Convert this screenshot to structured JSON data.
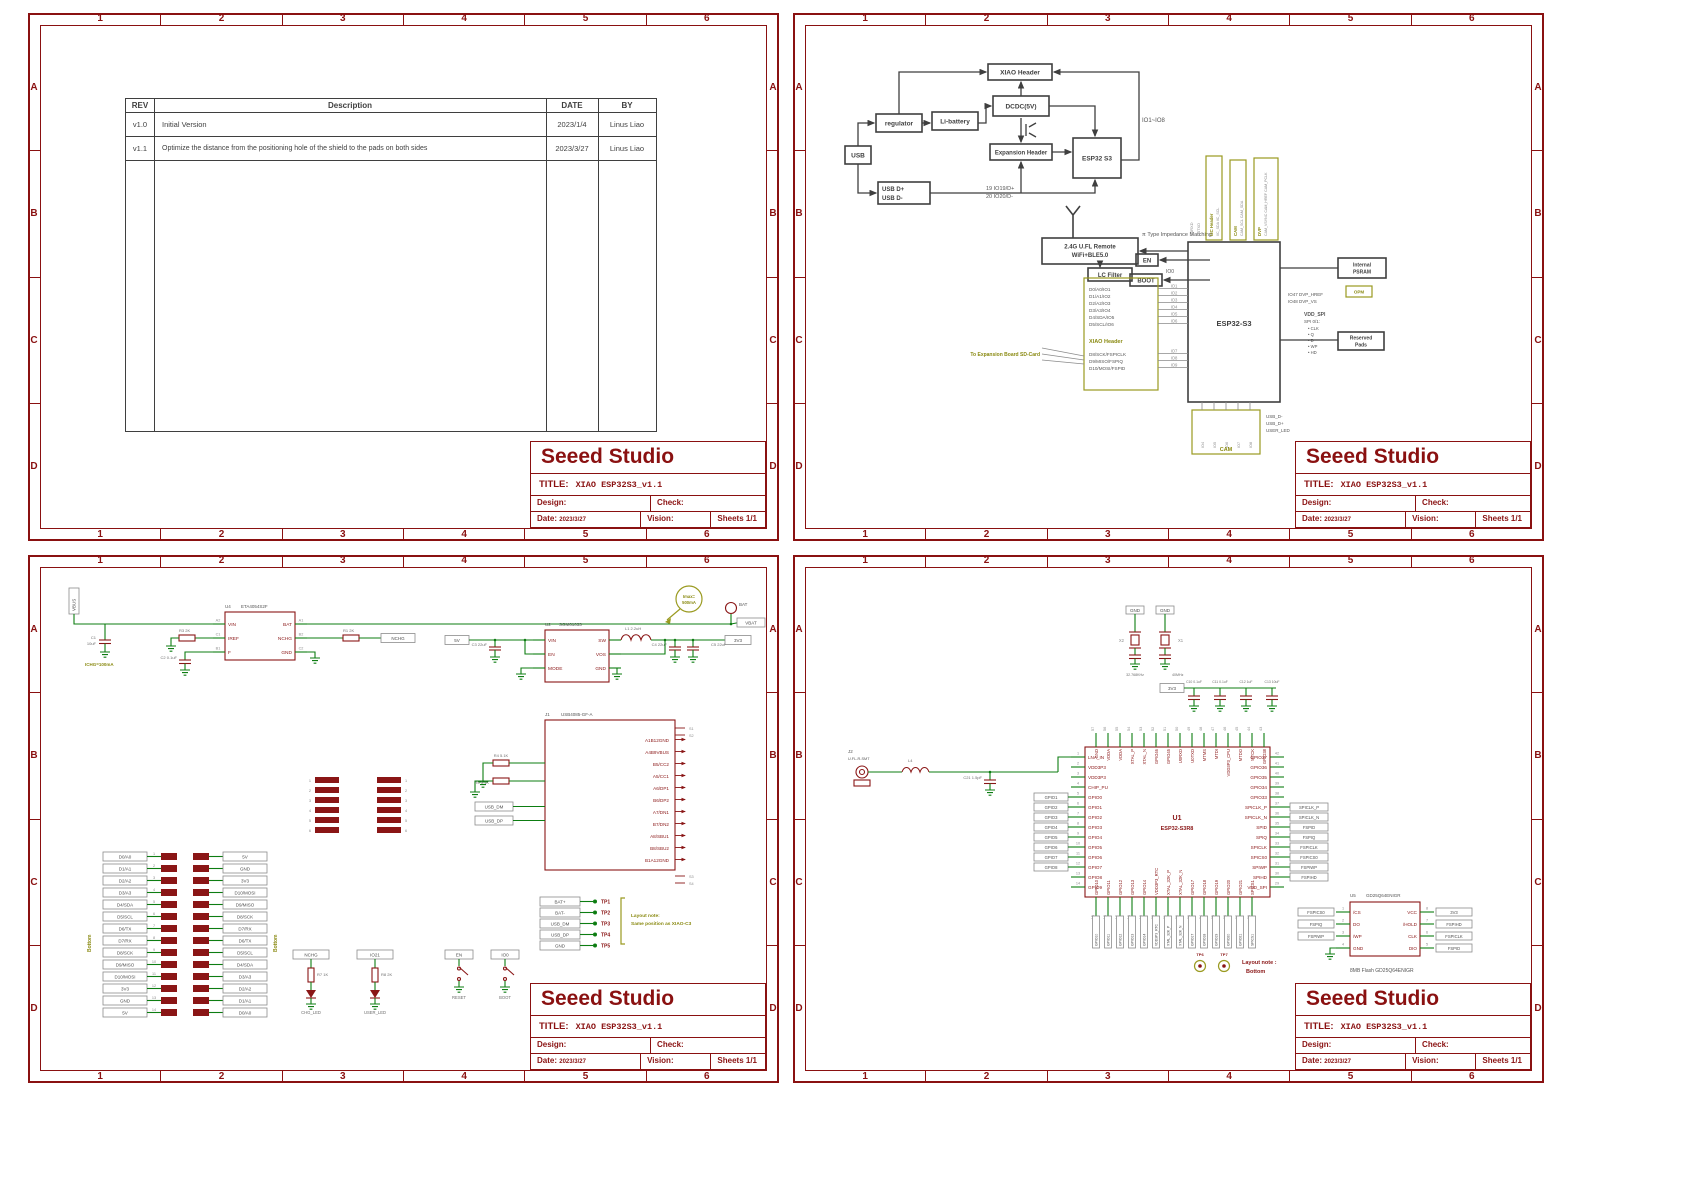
{
  "frame": {
    "cols": [
      "1",
      "2",
      "3",
      "4",
      "5",
      "6"
    ],
    "rows": [
      "A",
      "B",
      "C",
      "D"
    ]
  },
  "title_block": {
    "company": "Seeed Studio",
    "title_label": "TITLE:",
    "title": "XIAO ESP32S3_v1.1",
    "design_label": "Design:",
    "check_label": "Check:",
    "date_label": "Date:",
    "date_value": "2023/3/27",
    "vision_label": "Vision:",
    "sheets_value": "Sheets 1/1"
  },
  "rev_table": {
    "headers": [
      "REV",
      "Description",
      "DATE",
      "BY"
    ],
    "rows": [
      {
        "rev": "v1.0",
        "desc": "Initial Version",
        "date": "2023/1/4",
        "by": "Linus Liao"
      },
      {
        "rev": "v1.1",
        "desc": "Optimize the distance from the positioning hole of the shield to the pads on both sides",
        "date": "2023/3/27",
        "by": "Linus Liao"
      }
    ]
  },
  "p2": {
    "bd": {
      "usb": "USB",
      "regulator": "regulator",
      "li_battery": "Li-battery",
      "xiao_header": "XIAO Header",
      "dcdc": "DCDC(5V)",
      "expansion": "Expansion Header",
      "esp32": "ESP32 S3",
      "usb_dp": "USB D+",
      "usb_dn": "USB D-",
      "net_dp": "19 IO19/D+",
      "net_dn": "20 IO20/D-",
      "io_range": "IO1~IO8"
    },
    "rf": {
      "remote1": "2.4G U.FL Remote",
      "remote2": "WiFi+BLE5.0",
      "matching": "π Type Impedance Matching",
      "lc": "LC Filter",
      "en": "EN",
      "boot": "BOOT",
      "io0": "IO0",
      "chip": "ESP32-S3",
      "xiao_label": "XIAO Header",
      "list_a": [
        "D0/A0/IO1",
        "D1/A1/IO2",
        "D2/A2/IO3",
        "D3/A3/IO4",
        "D4/SDA/IO5",
        "D5/SCL/IO6"
      ],
      "nums_a": [
        "IO1",
        "IO2",
        "IO3",
        "IO4",
        "IO5",
        "IO6"
      ],
      "list_b": [
        "D8/SCK/FSPICLK",
        "D9/MISO/FSPIQ",
        "D10/MOSI/FSPID"
      ],
      "nums_b": [
        "IO7",
        "IO8",
        "IO9"
      ],
      "sd_note": "To Expansion Board SD-Card",
      "vboxes": [
        {
          "cap": "I2C Header",
          "nets": "IIC_SDA IIC_SCL"
        },
        {
          "cap": "CAM",
          "nets": "CAM_SCL CAM_SDA"
        },
        {
          "cap": "DVP",
          "nets": "CAM_VSYNC CAM_HREF CAM_PCLK"
        }
      ],
      "u0": [
        "U0RXD",
        "U0TXD"
      ],
      "psram1": "Internal",
      "psram2": "PSRAM",
      "opm": "OPM",
      "dvp1": "IO47  DVP_HREF",
      "dvp2": "IO48  DVP_VS",
      "vdd_spi": "VDD_SPI",
      "spi01": "SPI 0/1:",
      "spi_list": [
        "• CLK",
        "• Q",
        "• D",
        "• WP",
        "• HD"
      ],
      "reserved1": "Reserved",
      "reserved2": "Pads",
      "cam": "CAM",
      "cam_nets": [
        "IO4",
        "IO5",
        "IO6",
        "IO7",
        "IO8"
      ],
      "below": [
        "USB_D-",
        "USB_D+",
        "USER_LED"
      ]
    }
  },
  "p3": {
    "vbus": "VBUS",
    "u4": "U4",
    "u4_part": "ETA4054S2F",
    "u4_lpins": [
      {
        "n": "A2",
        "p": "VIN"
      },
      {
        "n": "C1",
        "p": "IREF"
      },
      {
        "n": "B1",
        "p": "F"
      }
    ],
    "u4_rpins": [
      {
        "n": "A1",
        "p": "BAT"
      },
      {
        "n": "B2",
        "p": "NCHG"
      },
      {
        "n": "C2",
        "p": "GND"
      }
    ],
    "c1": "C1",
    "c1v": "10uF",
    "r3": "R3 2K",
    "c2": "C2 0.1uF",
    "chg_note": "ICHG=100mA",
    "bat": "BAT",
    "vbat": "VBAT",
    "nchg": "NCHG",
    "r1": "R1 2K",
    "imax1": "Imax=",
    "imax2": "500mA",
    "v5": "5V",
    "u2": "U2",
    "u2_part": "SGM61033",
    "u2_l": [
      "VIN",
      "EN",
      "MODE"
    ],
    "u2_r": [
      "SW",
      "VOS",
      "GND"
    ],
    "l1": "L1 2.2uH",
    "c3": "C3 22uF",
    "c4": "C4 22uF",
    "c5": "C5 22uF",
    "v33": "3V3",
    "j1": "J1",
    "j1_part": "USB4085-GF-A",
    "usbc_pins": [
      "A1B12GND",
      "A4B9VBUS",
      "B5/CC2",
      "A5/CC1",
      "A6/DP1",
      "B6/DP2",
      "A7/DN1",
      "B7/DN2",
      "A8/SBU1",
      "B8/SBU2",
      "B1A12GND"
    ],
    "s_top": [
      "S1",
      "S2"
    ],
    "s_bot": [
      "S3",
      "S4"
    ],
    "r4": "R4 5.1K",
    "r5": "R5 5.1K",
    "dm": "USB_DM",
    "dp": "USB_DP",
    "tp": [
      {
        "net": "BAT+",
        "tp": "TP1"
      },
      {
        "net": "BAT-",
        "tp": "TP2"
      },
      {
        "net": "USB_DM",
        "tp": "TP3"
      },
      {
        "net": "USB_DP",
        "tp": "TP4"
      },
      {
        "net": "GND",
        "tp": "TP5"
      }
    ],
    "tp_note1": "Layout note:",
    "tp_note2": "Same position as XIAO-C3",
    "hdr_left": [
      "D0/A0",
      "D1/A1",
      "D2/A2",
      "D3/A3",
      "D4/SDA",
      "D5/SCL",
      "D6/TX",
      "D7/RX",
      "D8/SCK",
      "D9/MISO",
      "D10/MOSI",
      "3V3",
      "GND",
      "5V"
    ],
    "hdr_right": [
      "5V",
      "GND",
      "3V3",
      "D10/MOSI",
      "D9/MISO",
      "D8/SCK",
      "D7/RX",
      "D6/TX",
      "D5/SCL",
      "D4/SDA",
      "D3/A3",
      "D2/A2",
      "D1/A1",
      "D0/A0"
    ],
    "hdr_nums": [
      "1",
      "2",
      "3",
      "4",
      "5",
      "6",
      "7",
      "8",
      "9",
      "10",
      "11",
      "12",
      "13",
      "14"
    ],
    "bottom_note": "Bottom",
    "padsA": [
      "1",
      "2",
      "3",
      "4",
      "5",
      "6"
    ],
    "padsB": [
      "1",
      "2",
      "3",
      "4",
      "5",
      "6"
    ],
    "leds": [
      {
        "net": "NCHG",
        "r": "R7 1K",
        "name": "CHG_LED"
      },
      {
        "net": "IO21",
        "r": "R8 2K",
        "name": "USER_LED"
      }
    ],
    "btns": [
      {
        "net": "EN",
        "name": "RESET"
      },
      {
        "net": "IO0",
        "name": "BOOT"
      }
    ]
  },
  "p4": {
    "gnd2": [
      "GND",
      "GND"
    ],
    "x2": "X2",
    "x1": "X1",
    "x2v": "32.768KHz",
    "x1v": "40MHz",
    "rail": "3V3",
    "caps": [
      "C10 0.1uF",
      "C11 0.1uF",
      "C12 1uF",
      "C13 10uF"
    ],
    "j2": "J2",
    "j2_part": "U.FL-R-SMT",
    "l4": "L4",
    "c21": "C21 1.5pF",
    "mcu_ref": "U1",
    "mcu_part": "ESP32-S3R8",
    "left": [
      {
        "n": "1",
        "p": "LNA_IN"
      },
      {
        "n": "2",
        "p": "VDD3P3"
      },
      {
        "n": "3",
        "p": "VDD3P3"
      },
      {
        "n": "4",
        "p": "CHIP_PU"
      },
      {
        "n": "5",
        "p": "GPIO0"
      },
      {
        "n": "6",
        "p": "GPIO1"
      },
      {
        "n": "7",
        "p": "GPIO2"
      },
      {
        "n": "8",
        "p": "GPIO3"
      },
      {
        "n": "9",
        "p": "GPIO4"
      },
      {
        "n": "10",
        "p": "GPIO5"
      },
      {
        "n": "11",
        "p": "GPIO6"
      },
      {
        "n": "12",
        "p": "GPIO7"
      },
      {
        "n": "13",
        "p": "GPIO8"
      },
      {
        "n": "14",
        "p": "GPIO9"
      }
    ],
    "bottom": [
      {
        "n": "15",
        "p": "GPIO10"
      },
      {
        "n": "16",
        "p": "GPIO11"
      },
      {
        "n": "17",
        "p": "GPIO12"
      },
      {
        "n": "18",
        "p": "GPIO13"
      },
      {
        "n": "19",
        "p": "GPIO14"
      },
      {
        "n": "20",
        "p": "VDD3P3_RTC"
      },
      {
        "n": "21",
        "p": "XTAL_32K_P"
      },
      {
        "n": "22",
        "p": "XTAL_32K_N"
      },
      {
        "n": "23",
        "p": "GPIO17"
      },
      {
        "n": "24",
        "p": "GPIO18"
      },
      {
        "n": "25",
        "p": "GPIO19"
      },
      {
        "n": "26",
        "p": "GPIO20"
      },
      {
        "n": "27",
        "p": "GPIO21"
      },
      {
        "n": "28",
        "p": "SPICS1"
      }
    ],
    "right": [
      {
        "n": "42",
        "p": "GPIO37"
      },
      {
        "n": "41",
        "p": "GPIO36"
      },
      {
        "n": "40",
        "p": "GPIO35"
      },
      {
        "n": "39",
        "p": "GPIO34"
      },
      {
        "n": "38",
        "p": "GPIO33"
      },
      {
        "n": "37",
        "p": "SPICLK_P"
      },
      {
        "n": "36",
        "p": "SPICLK_N"
      },
      {
        "n": "35",
        "p": "SPID"
      },
      {
        "n": "34",
        "p": "SPIQ"
      },
      {
        "n": "33",
        "p": "SPICLK"
      },
      {
        "n": "32",
        "p": "SPICS0"
      },
      {
        "n": "31",
        "p": "SPIWP"
      },
      {
        "n": "30",
        "p": "SPIHD"
      },
      {
        "n": "29",
        "p": "VDD_SPI"
      }
    ],
    "top": [
      {
        "n": "57",
        "p": "GND"
      },
      {
        "n": "56",
        "p": "VDDA"
      },
      {
        "n": "55",
        "p": "VDDA"
      },
      {
        "n": "54",
        "p": "XTAL_P"
      },
      {
        "n": "53",
        "p": "XTAL_N"
      },
      {
        "n": "52",
        "p": "GPIO46"
      },
      {
        "n": "51",
        "p": "GPIO45"
      },
      {
        "n": "50",
        "p": "U0RXD"
      },
      {
        "n": "49",
        "p": "U0TXD"
      },
      {
        "n": "48",
        "p": "MTMS"
      },
      {
        "n": "47",
        "p": "MTDI"
      },
      {
        "n": "46",
        "p": "VDD3P3_CPU"
      },
      {
        "n": "45",
        "p": "MTDO"
      },
      {
        "n": "44",
        "p": "MTCK"
      },
      {
        "n": "43",
        "p": "GPIO38"
      }
    ],
    "left_nets": [
      "GPIO1",
      "GPIO2",
      "GPIO3",
      "GPIO4",
      "GPIO5",
      "GPIO6",
      "GPIO7",
      "GPIO8"
    ],
    "right_nets": [
      "SPICLK_P",
      "SPICLK_N",
      "FSPID",
      "FSPIQ",
      "FSPICLK",
      "FSPICS0",
      "FSPIWP",
      "FSPIHD"
    ],
    "tps": [
      "TP6",
      "TP7"
    ],
    "note1": "Layout note :",
    "note2": "Bottom",
    "flash_ref": "U5",
    "flash_part": "GD25Q64ENIGR",
    "fl_l": [
      {
        "n": "1",
        "p": "/CS"
      },
      {
        "n": "2",
        "p": "DO"
      },
      {
        "n": "3",
        "p": "/WP"
      },
      {
        "n": "4",
        "p": "GND"
      }
    ],
    "fl_r": [
      {
        "n": "8",
        "p": "VCC"
      },
      {
        "n": "7",
        "p": "/HOLD"
      },
      {
        "n": "6",
        "p": "CLK"
      },
      {
        "n": "5",
        "p": "DIO"
      }
    ],
    "fl_lnets": [
      "FSPICS0",
      "FSPIQ",
      "FSPIWP"
    ],
    "fl_rnets": [
      "3V3",
      "FSPIHD",
      "FSPICLK",
      "FSPID"
    ],
    "flash_caption": "8MB Flash  GD25Q64ENIGR",
    "v33": "3V3"
  }
}
